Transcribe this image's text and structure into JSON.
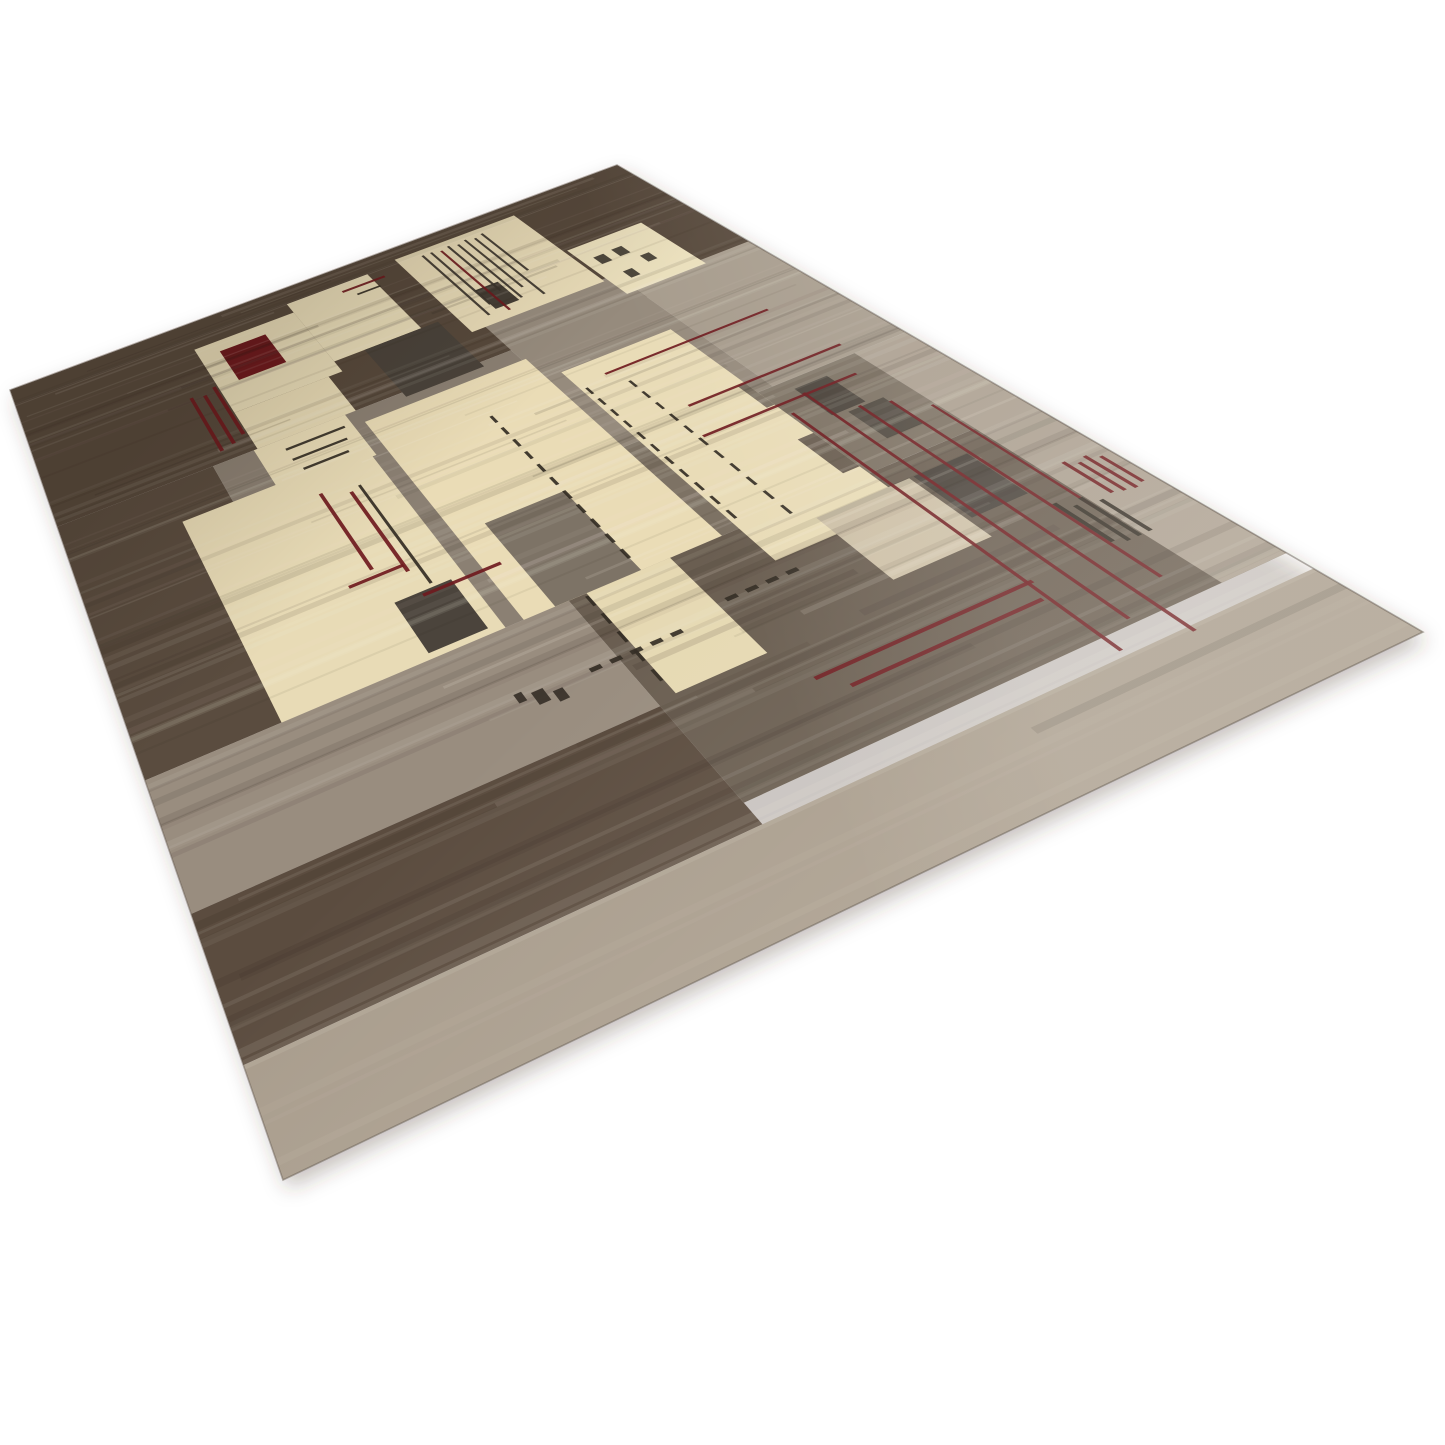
{
  "scene": {
    "background": "#ffffff",
    "width": 1445,
    "height": 1445,
    "description": "Angled product photo of a hand-knotted wool rug with abstract geometric patchwork in cream, taupe, brown and charcoal, accented by thin dark-red grid lines and black stitch marks, on a plain white background"
  },
  "rug": {
    "corners": [
      [
        10,
        390
      ],
      [
        617,
        165
      ],
      [
        1423,
        632
      ],
      [
        283,
        1180
      ]
    ],
    "edge": {
      "stroke": "rgba(92,80,68,0.45)",
      "width": 1.6
    },
    "shadow": {
      "dx": 5,
      "dy": 9,
      "blur": 10,
      "color": "rgba(70,58,46,0.30)"
    },
    "palette": {
      "dark_brown": "#57493c",
      "mid_taupe": "#8b8073",
      "gray": "#968b7d",
      "light_gray": "#a79c8d",
      "dark_graybrown": "#6a5e51",
      "light_band": "#a89c8c",
      "cream": "#e9dcb8",
      "charcoal": "#4a433b",
      "maroon": "#6f1a1e",
      "stitch_black": "#332c24"
    },
    "bands": [
      {
        "rect": [
          0,
          0,
          1,
          0.305
        ],
        "color": "#57493c"
      },
      {
        "rect": [
          0,
          0.305,
          0.205,
          0.672
        ],
        "color": "#5a4c3f"
      },
      {
        "rect": [
          0.205,
          0.305,
          0.62,
          0.672
        ],
        "color": "#8b8073"
      },
      {
        "rect": [
          0.62,
          0.24,
          0.82,
          0.52
        ],
        "color": "#968b7d"
      },
      {
        "rect": [
          0.82,
          0.275,
          1,
          0.52
        ],
        "color": "#a79c8d"
      },
      {
        "rect": [
          0.45,
          0.672,
          1,
          0.905
        ],
        "color": "#6a5e51"
      },
      {
        "rect": [
          0,
          0.672,
          0.45,
          0.805
        ],
        "color": "#998d7f"
      },
      {
        "rect": [
          0,
          0.805,
          0.45,
          0.925
        ],
        "color": "#5b4c3f"
      },
      {
        "rect": [
          0,
          0.925,
          1,
          1
        ],
        "color": "#a89c8c"
      },
      {
        "rect": [
          0.93,
          0.52,
          1,
          0.905
        ],
        "color": "#ab9f90"
      },
      {
        "rect": [
          0.62,
          0.52,
          0.93,
          0.672
        ],
        "color": "#7d7264"
      }
    ],
    "blocks": [
      {
        "rect": [
          0.265,
          0.065,
          0.42,
          0.225
        ],
        "color": "#e8dcb8"
      },
      {
        "rect": [
          0.42,
          0.04,
          0.55,
          0.2
        ],
        "color": "#eadeba"
      },
      {
        "rect": [
          0.265,
          0.225,
          0.4,
          0.305
        ],
        "color": "#e7dab5"
      },
      {
        "rect": [
          0.26,
          0.305,
          0.385,
          0.39
        ],
        "color": "#e9dcb7"
      },
      {
        "rect": [
          0.295,
          0.09,
          0.365,
          0.165
        ],
        "color": "#6e1a1e"
      },
      {
        "rect": [
          0.465,
          0.2,
          0.575,
          0.315
        ],
        "color": "#4a433b"
      },
      {
        "rect": [
          0.6,
          0.03,
          0.8,
          0.245
        ],
        "color": "#e9dcb8"
      },
      {
        "rect": [
          0.652,
          0.165,
          0.688,
          0.218
        ],
        "color": "#453e35"
      },
      {
        "rect": [
          0.805,
          0.155,
          0.925,
          0.285
        ],
        "color": "#eadfbc"
      },
      {
        "rect": [
          0.14,
          0.375,
          0.38,
          0.672
        ],
        "color": "#e8dbb6"
      },
      {
        "rect": [
          0.3,
          0.595,
          0.365,
          0.665
        ],
        "color": "#4b443c"
      },
      {
        "rect": [
          0.4,
          0.33,
          0.625,
          0.672
        ],
        "color": "#eadcb6"
      },
      {
        "rect": [
          0.435,
          0.545,
          0.532,
          0.672
        ],
        "color": "#7d7366"
      },
      {
        "rect": [
          0.645,
          0.375,
          0.8,
          0.72
        ],
        "color": "#e9dcb7"
      },
      {
        "rect": [
          0.78,
          0.6,
          0.8,
          0.66
        ],
        "color": "#6a5e51"
      },
      {
        "rect": [
          0.79,
          0.5,
          0.8,
          0.545
        ],
        "color": "#7d7264"
      },
      {
        "rect": [
          0.835,
          0.535,
          0.878,
          0.588
        ],
        "color": "#4c453d"
      },
      {
        "rect": [
          0.852,
          0.592,
          0.897,
          0.642
        ],
        "color": "#514a41"
      },
      {
        "rect": [
          0.47,
          0.672,
          0.565,
          0.8
        ],
        "color": "#e6d9b3"
      },
      {
        "rect": [
          0.715,
          0.695,
          0.825,
          0.785
        ],
        "color": "#cdc0a7"
      },
      {
        "rect": [
          0.83,
          0.695,
          0.895,
          0.76
        ],
        "color": "#4a433c"
      }
    ],
    "lines": [
      {
        "o": "v",
        "pos": 0.805,
        "from": 0.565,
        "to": 0.92,
        "w": 0.0038,
        "color": "#6f1a1e"
      },
      {
        "o": "v",
        "pos": 0.838,
        "from": 0.545,
        "to": 0.9,
        "w": 0.0038,
        "color": "#6f1a1e"
      },
      {
        "o": "v",
        "pos": 0.868,
        "from": 0.59,
        "to": 0.93,
        "w": 0.0038,
        "color": "#6f1a1e"
      },
      {
        "o": "v",
        "pos": 0.898,
        "from": 0.6,
        "to": 0.88,
        "w": 0.0038,
        "color": "#6f1a1e"
      },
      {
        "o": "v",
        "pos": 0.926,
        "from": 0.625,
        "to": 0.8,
        "w": 0.0033,
        "color": "#6f1a1e"
      },
      {
        "o": "v",
        "pos": 0.225,
        "from": 0.165,
        "to": 0.285,
        "w": 0.005,
        "color": "#6f1a1e"
      },
      {
        "o": "v",
        "pos": 0.243,
        "from": 0.17,
        "to": 0.28,
        "w": 0.005,
        "color": "#6f1a1e"
      },
      {
        "o": "v",
        "pos": 0.26,
        "from": 0.16,
        "to": 0.27,
        "w": 0.005,
        "color": "#6f1a1e"
      },
      {
        "o": "v",
        "pos": 0.3,
        "from": 0.415,
        "to": 0.545,
        "w": 0.0045,
        "color": "#6f1a1e"
      },
      {
        "o": "v",
        "pos": 0.332,
        "from": 0.43,
        "to": 0.565,
        "w": 0.0045,
        "color": "#6f1a1e"
      },
      {
        "o": "v",
        "pos": 0.532,
        "from": 0.4,
        "to": 0.665,
        "w": 0.004,
        "color": "#332c24",
        "dash": true
      },
      {
        "o": "v",
        "pos": 0.345,
        "from": 0.425,
        "to": 0.59,
        "w": 0.0035,
        "color": "#332c24"
      },
      {
        "o": "v",
        "pos": 0.652,
        "from": 0.415,
        "to": 0.67,
        "w": 0.0035,
        "color": "#332c24",
        "dash": true
      },
      {
        "o": "v",
        "pos": 0.7,
        "from": 0.43,
        "to": 0.69,
        "w": 0.0035,
        "color": "#332c24",
        "dash": true
      },
      {
        "o": "v",
        "pos": 0.468,
        "from": 0.675,
        "to": 0.795,
        "w": 0.0035,
        "color": "#332c24",
        "dash": true
      },
      {
        "o": "v",
        "pos": 0.638,
        "from": 0.045,
        "to": 0.225,
        "w": 0.0036,
        "color": "#3b342c"
      },
      {
        "o": "v",
        "pos": 0.652,
        "from": 0.045,
        "to": 0.205,
        "w": 0.0036,
        "color": "#3b342c"
      },
      {
        "o": "v",
        "pos": 0.666,
        "from": 0.05,
        "to": 0.23,
        "w": 0.0036,
        "color": "#6f1a1e"
      },
      {
        "o": "v",
        "pos": 0.68,
        "from": 0.045,
        "to": 0.185,
        "w": 0.0036,
        "color": "#3b342c"
      },
      {
        "o": "v",
        "pos": 0.694,
        "from": 0.05,
        "to": 0.215,
        "w": 0.0036,
        "color": "#3b342c"
      },
      {
        "o": "v",
        "pos": 0.708,
        "from": 0.045,
        "to": 0.195,
        "w": 0.0036,
        "color": "#3b342c"
      },
      {
        "o": "v",
        "pos": 0.722,
        "from": 0.05,
        "to": 0.225,
        "w": 0.0036,
        "color": "#3b342c"
      },
      {
        "o": "v",
        "pos": 0.736,
        "from": 0.045,
        "to": 0.165,
        "w": 0.0036,
        "color": "#3b342c"
      },
      {
        "o": "h",
        "pos": 0.405,
        "from": 0.685,
        "to": 0.915,
        "w": 0.0035,
        "color": "#6f1a1e"
      },
      {
        "o": "h",
        "pos": 0.5,
        "from": 0.725,
        "to": 0.93,
        "w": 0.0035,
        "color": "#6f1a1e"
      },
      {
        "o": "h",
        "pos": 0.548,
        "from": 0.705,
        "to": 0.905,
        "w": 0.0035,
        "color": "#6f1a1e"
      },
      {
        "o": "h",
        "pos": 0.838,
        "from": 0.58,
        "to": 0.81,
        "w": 0.0035,
        "color": "#6f1a1e"
      },
      {
        "o": "h",
        "pos": 0.856,
        "from": 0.6,
        "to": 0.8,
        "w": 0.0035,
        "color": "#6f1a1e"
      },
      {
        "o": "h",
        "pos": 0.06,
        "from": 0.5,
        "to": 0.568,
        "w": 0.005,
        "color": "#6f1a1e"
      },
      {
        "o": "h",
        "pos": 0.078,
        "from": 0.515,
        "to": 0.552,
        "w": 0.004,
        "color": "#332c24"
      },
      {
        "o": "h",
        "pos": 0.325,
        "from": 0.295,
        "to": 0.375,
        "w": 0.004,
        "color": "#332c24"
      },
      {
        "o": "h",
        "pos": 0.346,
        "from": 0.295,
        "to": 0.368,
        "w": 0.004,
        "color": "#332c24"
      },
      {
        "o": "h",
        "pos": 0.367,
        "from": 0.3,
        "to": 0.36,
        "w": 0.004,
        "color": "#332c24"
      },
      {
        "o": "h",
        "pos": 0.6,
        "from": 0.33,
        "to": 0.42,
        "w": 0.004,
        "color": "#6f1a1e"
      },
      {
        "o": "h",
        "pos": 0.748,
        "from": 0.42,
        "to": 0.528,
        "w": 0.0045,
        "color": "#332c24",
        "dash": true
      },
      {
        "o": "h",
        "pos": 0.737,
        "from": 0.575,
        "to": 0.665,
        "w": 0.0045,
        "color": "#332c24",
        "dash": true
      },
      {
        "o": "h",
        "pos": 0.555,
        "from": 0.268,
        "to": 0.332,
        "w": 0.004,
        "color": "#6f1a1e"
      }
    ],
    "marks": [
      {
        "u": 0.822,
        "v": 0.19,
        "w": 0.016,
        "h": 0.02,
        "color": "#453e35"
      },
      {
        "u": 0.852,
        "v": 0.188,
        "w": 0.016,
        "h": 0.02,
        "color": "#453e35"
      },
      {
        "u": 0.872,
        "v": 0.222,
        "w": 0.014,
        "h": 0.018,
        "color": "#453e35"
      },
      {
        "u": 0.832,
        "v": 0.24,
        "w": 0.014,
        "h": 0.018,
        "color": "#453e35"
      },
      {
        "u": 0.36,
        "v": 0.745,
        "w": 0.012,
        "h": 0.014,
        "color": "#3a332b"
      },
      {
        "u": 0.378,
        "v": 0.752,
        "w": 0.01,
        "h": 0.012,
        "color": "#3a332b"
      },
      {
        "u": 0.345,
        "v": 0.74,
        "w": 0.008,
        "h": 0.01,
        "color": "#3a332b"
      },
      {
        "u": 0.9,
        "v": 0.78,
        "w": 0.0045,
        "h": 0.055,
        "color": "#332c24"
      },
      {
        "u": 0.912,
        "v": 0.79,
        "w": 0.0045,
        "h": 0.05,
        "color": "#332c24"
      },
      {
        "u": 0.924,
        "v": 0.785,
        "w": 0.0045,
        "h": 0.055,
        "color": "#332c24"
      },
      {
        "u": 0.936,
        "v": 0.795,
        "w": 0.0045,
        "h": 0.045,
        "color": "#332c24"
      },
      {
        "u": 0.952,
        "v": 0.745,
        "w": 0.004,
        "h": 0.048,
        "color": "#6f1a1e"
      },
      {
        "u": 0.963,
        "v": 0.752,
        "w": 0.004,
        "h": 0.044,
        "color": "#6f1a1e"
      },
      {
        "u": 0.974,
        "v": 0.748,
        "w": 0.004,
        "h": 0.05,
        "color": "#6f1a1e"
      },
      {
        "u": 0.985,
        "v": 0.755,
        "w": 0.004,
        "h": 0.04,
        "color": "#6f1a1e"
      }
    ],
    "texture": {
      "seed": 13,
      "full": 75,
      "partial": 45,
      "light": "246,240,228",
      "dark": "36,28,20"
    },
    "overlays": [
      {
        "axis": "v",
        "stops": [
          [
            0,
            "rgba(25,15,5,0.16)"
          ],
          [
            0.28,
            "rgba(25,15,5,0)"
          ],
          [
            1,
            "rgba(25,15,5,0)"
          ]
        ]
      },
      {
        "axis": "v",
        "stops": [
          [
            0,
            "rgba(255,250,240,0)"
          ],
          [
            0.55,
            "rgba(255,250,240,0)"
          ],
          [
            1,
            "rgba(255,250,240,0.12)"
          ]
        ]
      },
      {
        "axis": "u",
        "stops": [
          [
            0,
            "rgba(255,252,246,0)"
          ],
          [
            0.72,
            "rgba(255,252,246,0)"
          ],
          [
            1,
            "rgba(255,252,246,0.10)"
          ]
        ]
      }
    ]
  }
}
